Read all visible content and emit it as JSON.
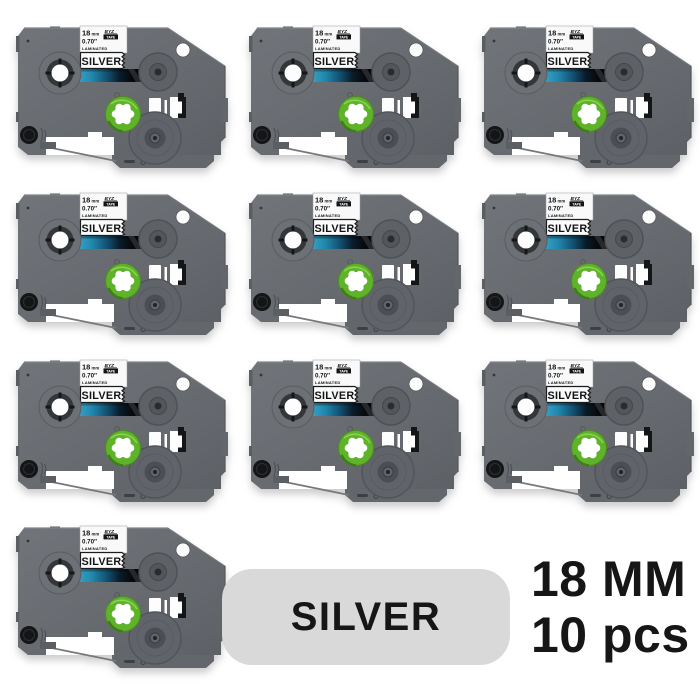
{
  "product": {
    "count_items": 10,
    "cassette_label": {
      "size_mm": "18",
      "size_unit": "mm",
      "brand": "BYZ",
      "brand_tape": "TAPE",
      "size_inches": "0.70″",
      "laminated": "LAMINATED",
      "color": "SILVER"
    },
    "badge_label": "SILVER",
    "info_line1": "18 MM",
    "info_line2": "10 pcs"
  },
  "colors": {
    "body_gray": "#676b70",
    "accent_green": "#5fb32a",
    "tape_teal": "#2b93b8",
    "badge_gray": "#d9d9d9",
    "label_white": "#f9f9f9",
    "text_black": "#161616"
  }
}
